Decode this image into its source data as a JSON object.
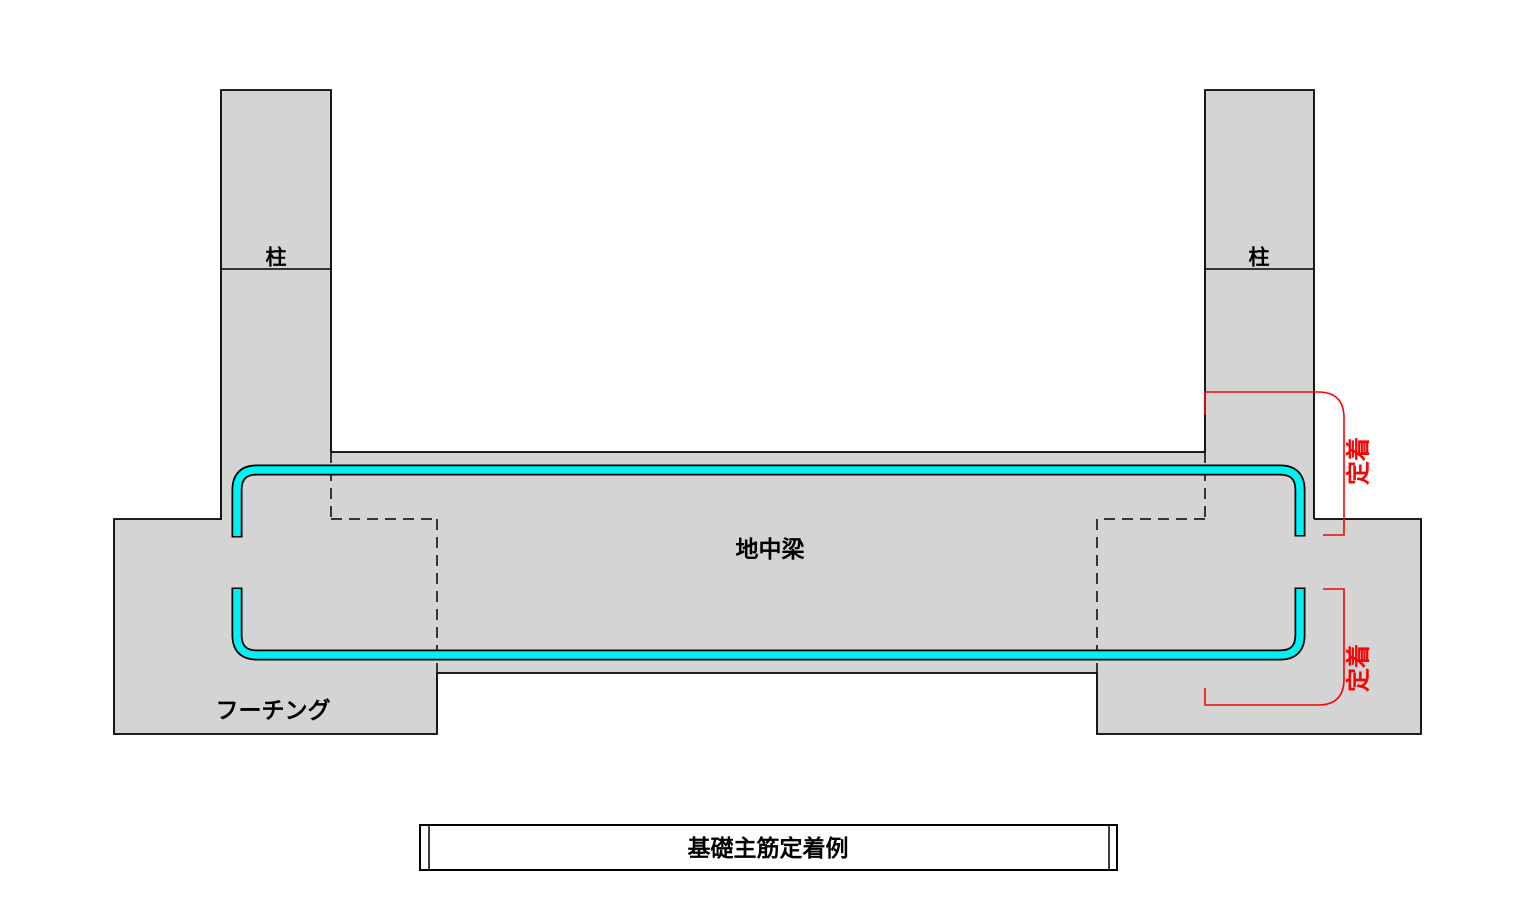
{
  "diagram": {
    "title": "基礎主筋定着例",
    "labels": {
      "column": "柱",
      "beam": "地中梁",
      "footing": "フーチング",
      "anchorage": "定着"
    },
    "colors": {
      "concrete_fill": "#d4d4d4",
      "outline": "#000000",
      "rebar": "#00f0f4",
      "annotation": "#f40606"
    }
  }
}
